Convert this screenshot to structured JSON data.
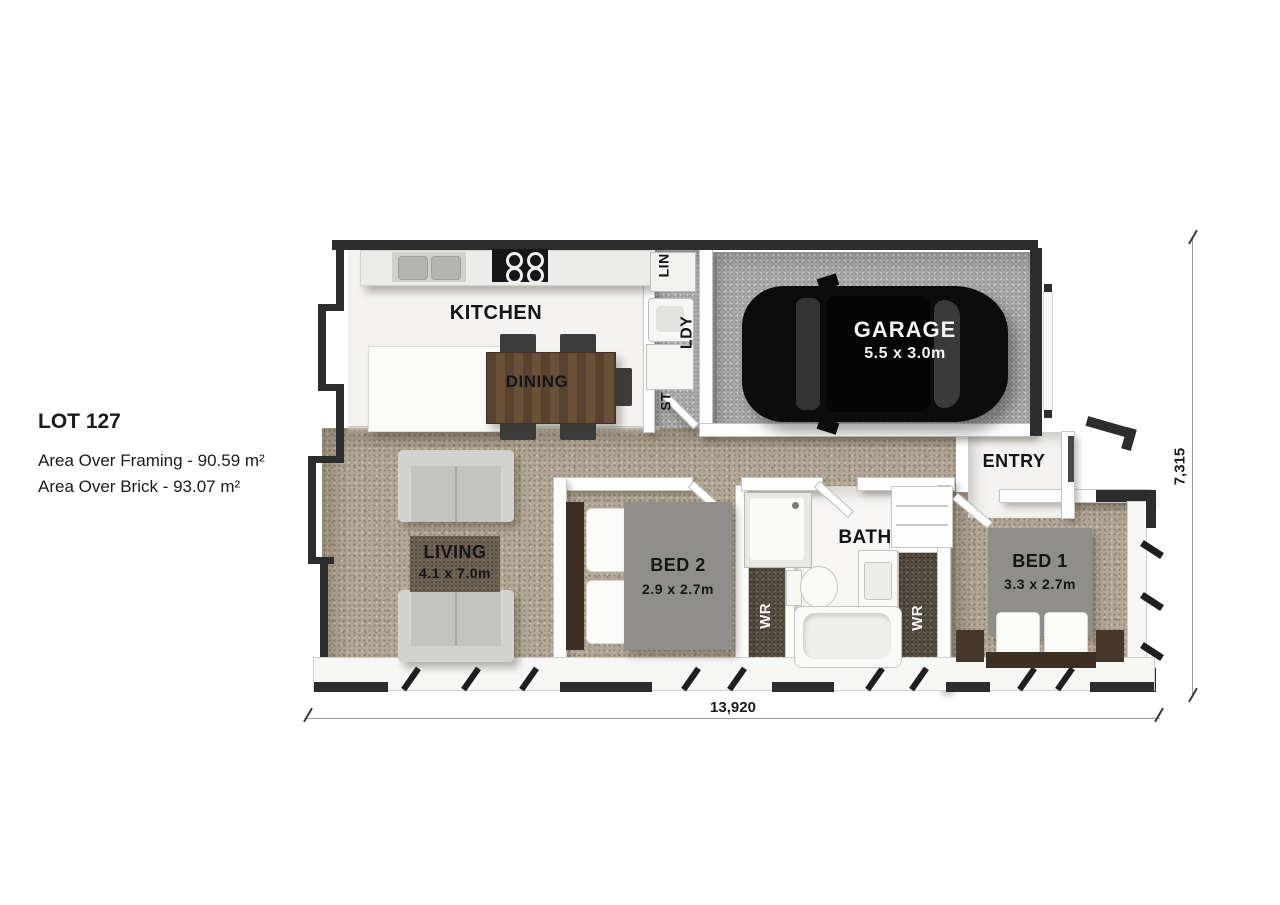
{
  "lot": {
    "title": "LOT 127",
    "area_framing": "Area Over Framing - 90.59 m²",
    "area_brick": "Area Over Brick - 93.07 m²"
  },
  "rooms": {
    "kitchen": "KITCHEN",
    "dining": "DINING",
    "living": "LIVING",
    "living_dims": "4.1 x 7.0m",
    "bed2": "BED 2",
    "bed2_dims": "2.9 x 2.7m",
    "bath": "BATH",
    "bed1": "BED 1",
    "bed1_dims": "3.3 x 2.7m",
    "garage": "GARAGE",
    "garage_dims": "5.5 x 3.0m",
    "entry": "ENTRY",
    "lin": "LIN",
    "ldy": "LDY",
    "st": "ST",
    "wr1": "WR",
    "wr2": "WR"
  },
  "dimensions": {
    "overall_width": "13,920",
    "overall_height": "7,315"
  }
}
